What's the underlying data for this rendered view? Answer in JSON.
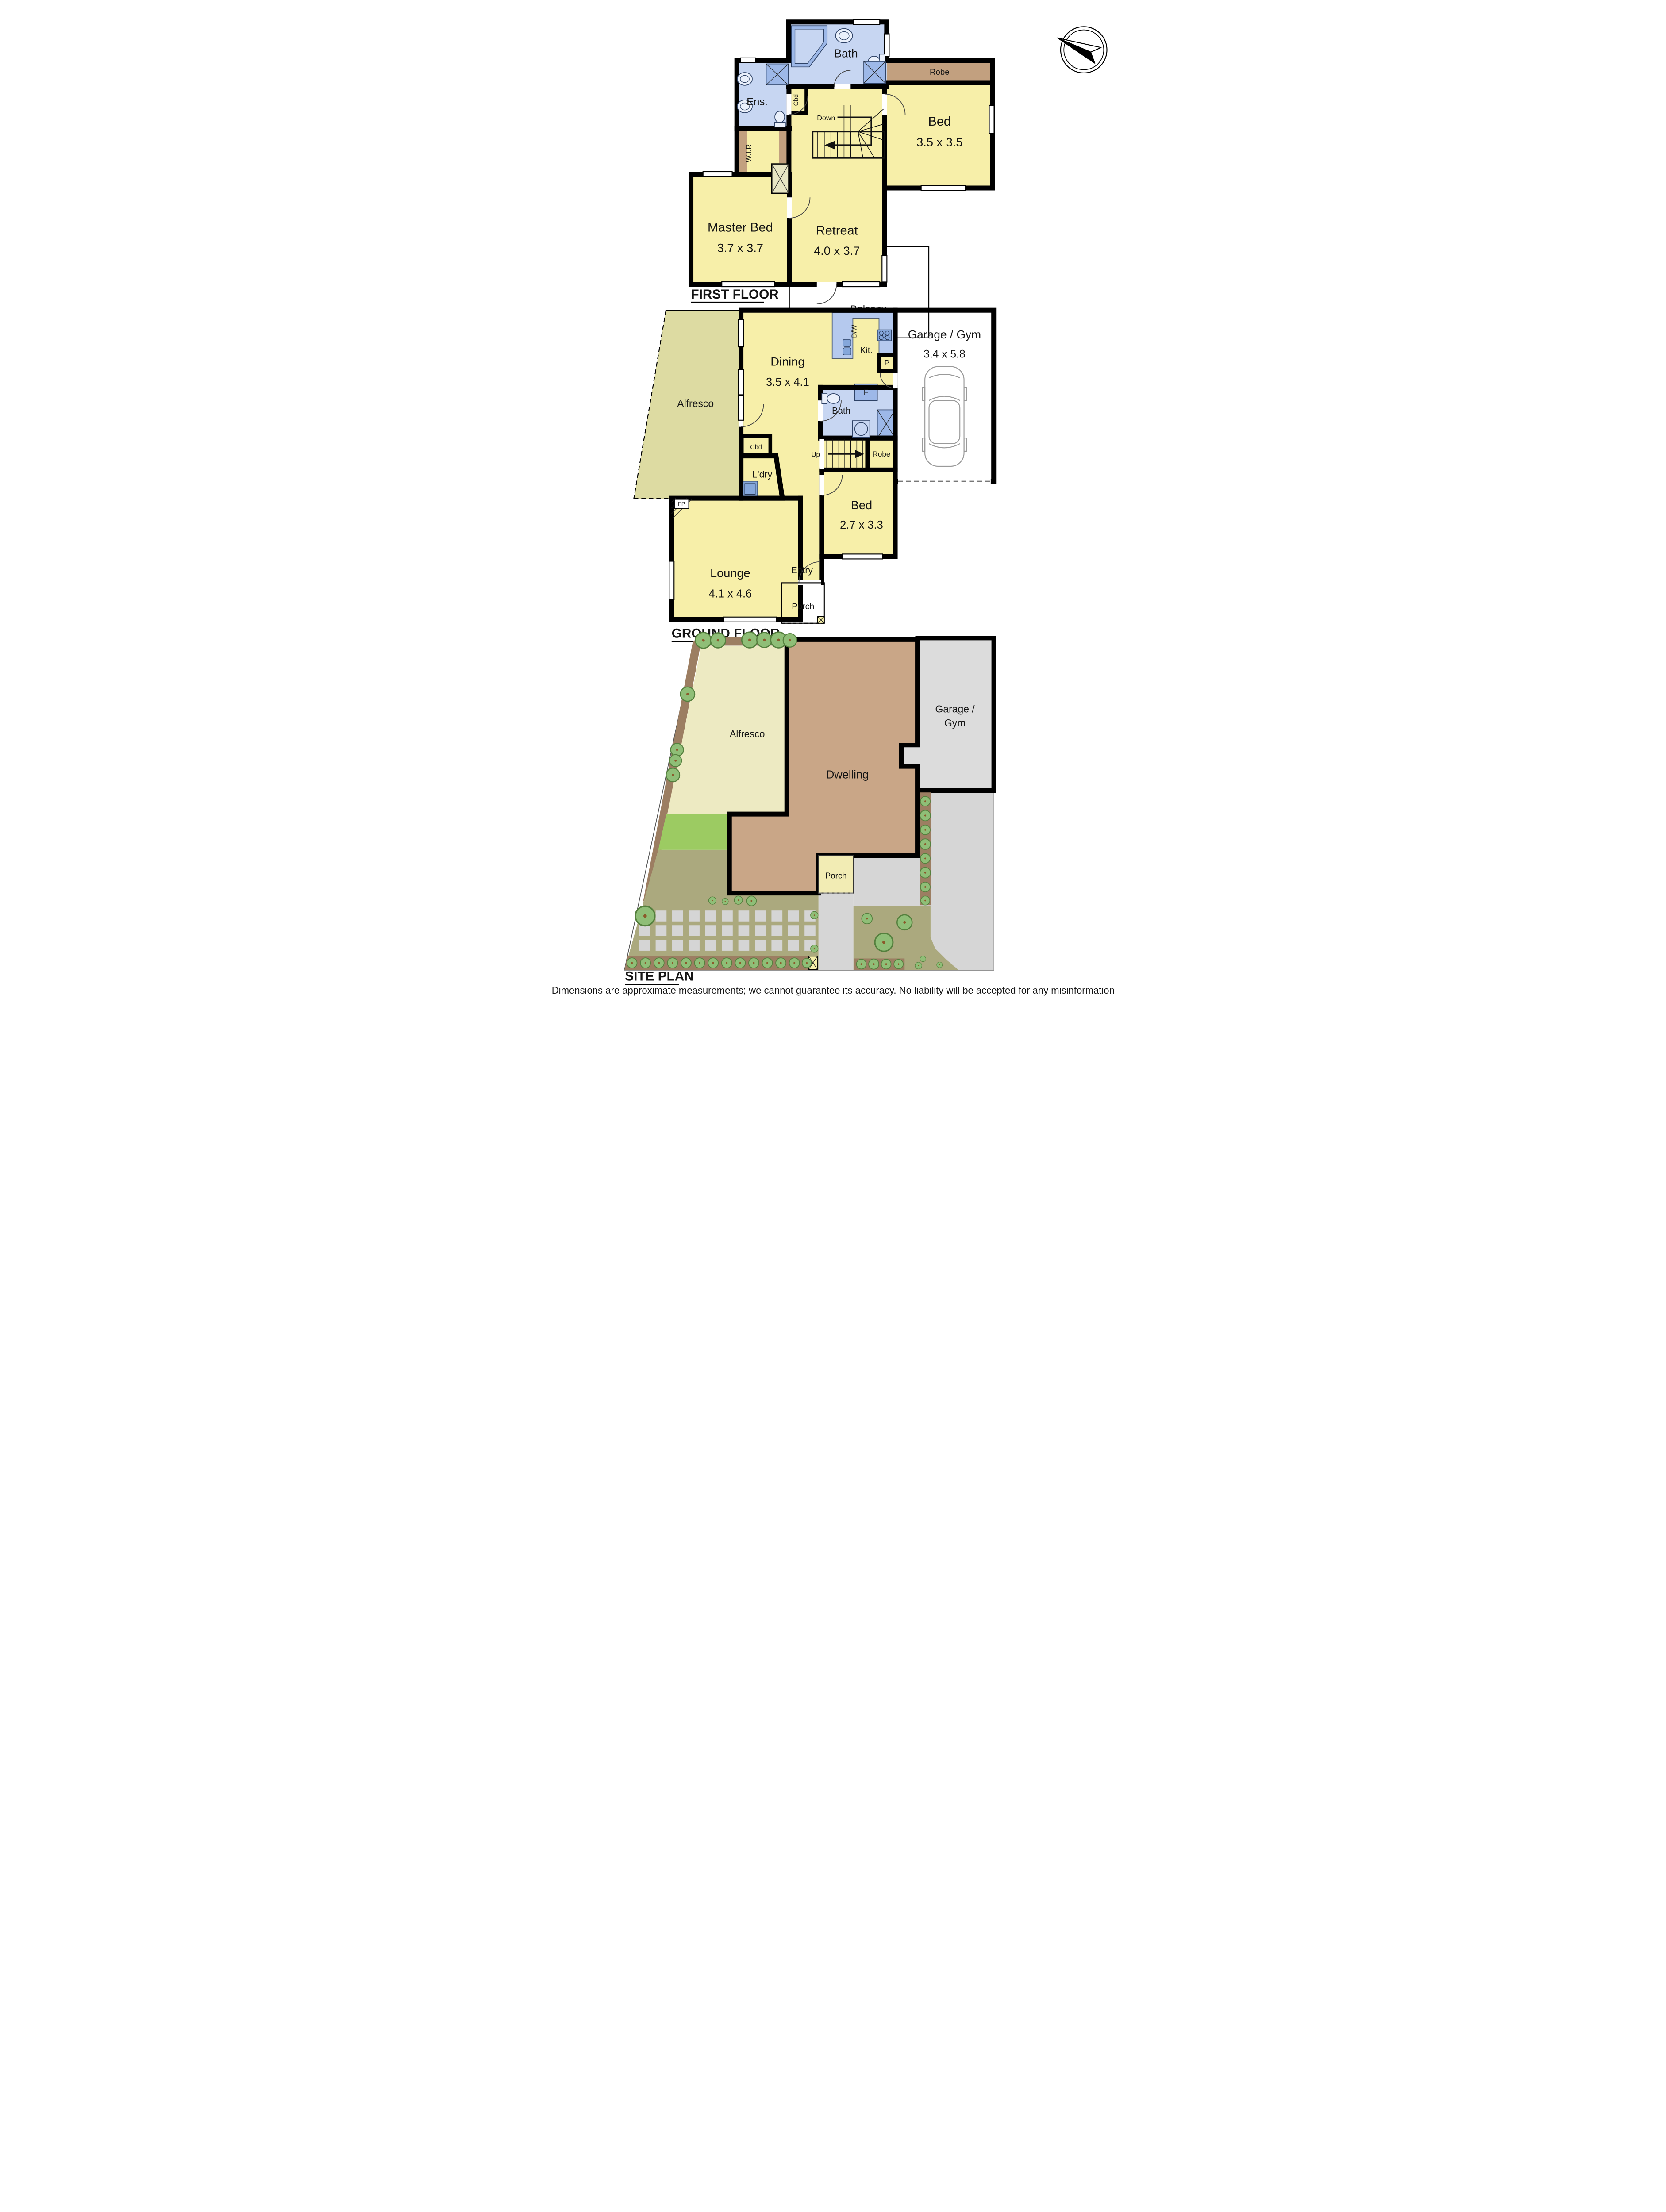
{
  "colors": {
    "wall": "#000000",
    "room_yellow": "#F7EFA9",
    "room_blue": "#C7D6F2",
    "fixture_blue": "#85A7DB",
    "counter_blue": "#B5C9EE",
    "robe_brown": "#C2A07F",
    "garage_gray": "#DCDCDC",
    "outdoor_olive": "#DDDBA2",
    "site_alfresco": "#EDEAC2",
    "lawn_green": "#9CCB62",
    "garden_khaki": "#ABA97E",
    "path_brown": "#9C7E62",
    "dwelling_tan": "#C9A687",
    "tree_green": "#8FBE77",
    "paver_gray": "#D5D5D5"
  },
  "first_floor": {
    "title": "FIRST FLOOR",
    "bath": "Bath",
    "ens": "Ens.",
    "cbd": "Cbd",
    "robe": "Robe",
    "bed": "Bed",
    "bed_dims": "3.5 x 3.5",
    "wir": "W.I.R",
    "master_bed": "Master Bed",
    "master_bed_dims": "3.7 x 3.7",
    "retreat": "Retreat",
    "retreat_dims": "4.0 x 3.7",
    "stairs": "Down",
    "balcony": "Balcony"
  },
  "ground_floor": {
    "title": "GROUND FLOOR",
    "dining": "Dining",
    "dining_dims": "3.5 x 4.1",
    "kitchen": "Kit.",
    "dishwasher": "D/W",
    "pantry": "P",
    "fridge": "F",
    "garage": "Garage / Gym",
    "garage_dims": "3.4 x 5.8",
    "alfresco": "Alfresco",
    "cbd": "Cbd",
    "laundry": "L'dry",
    "bath": "Bath",
    "stairs": "Up",
    "robe": "Robe",
    "fireplace": "FP",
    "lounge": "Lounge",
    "lounge_dims": "4.1 x 4.6",
    "entry": "Entry",
    "bed": "Bed",
    "bed_dims": "2.7 x 3.3",
    "porch": "Porch"
  },
  "site_plan": {
    "title": "SITE PLAN",
    "alfresco": "Alfresco",
    "dwelling": "Dwelling",
    "garage_line1": "Garage /",
    "garage_line2": "Gym",
    "porch": "Porch"
  },
  "footer": {
    "disclaimer": "Dimensions are approximate measurements; we cannot guarantee its accuracy. No liability will be accepted for any misinformation"
  }
}
